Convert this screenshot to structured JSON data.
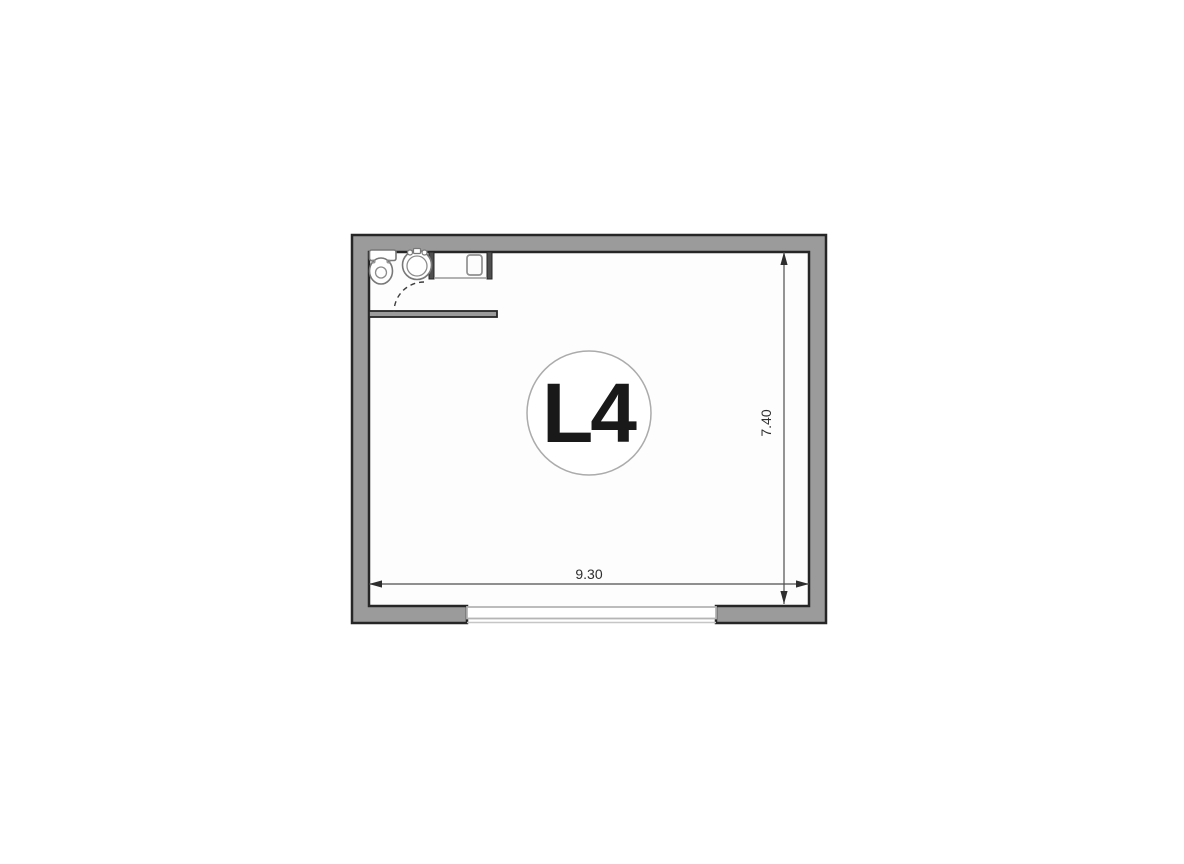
{
  "page": {
    "background_color": "#ffffff"
  },
  "floor_plan": {
    "unit_label": "L4",
    "dimensions": {
      "width_m": "9.30",
      "height_m": "7.40"
    },
    "colors": {
      "wall_fill": "#9b9b9b",
      "wall_outline": "#262626",
      "interior_fill": "#fdfdfd",
      "partition_fill": "#4f4f4f",
      "fixture_stroke": "#787878",
      "fixture_inner_stroke": "#8c8c8c",
      "window_line": "#b5b5b5",
      "threshold_line": "#c6c6c6",
      "dimension_color": "#2e2e2e",
      "door_arc_color": "#3d3d3d",
      "circle_outline": "#ababab",
      "label_color": "#191919"
    },
    "symbols": [
      "toilet",
      "washbasin",
      "appliance",
      "door-swing",
      "window-opening"
    ]
  }
}
